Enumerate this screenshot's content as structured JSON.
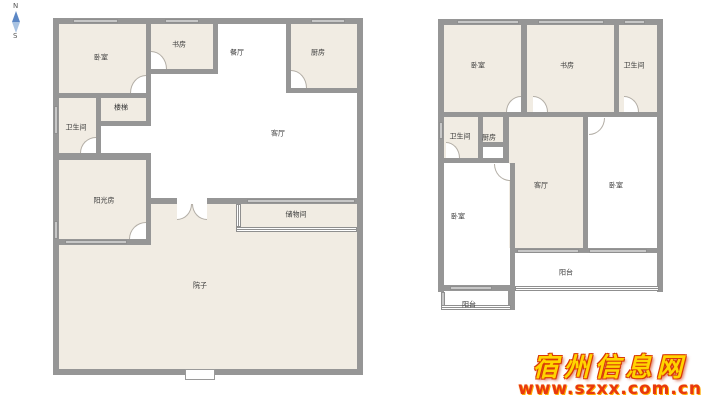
{
  "compass": {
    "north": "N",
    "south": "S"
  },
  "colors": {
    "wall": "#969696",
    "room_fill": "#f1ece3",
    "label_text": "#3a3a3a",
    "compass_needle": "#5b87c5",
    "watermark_gold": "#ffd400",
    "watermark_red": "#e8380d"
  },
  "left_plan": {
    "rooms": {
      "bedroom": "卧室",
      "study": "书房",
      "dining": "餐厅",
      "kitchen": "厨房",
      "living": "客厅",
      "stairs": "楼梯",
      "bathroom": "卫生间",
      "sunroom": "阳光房",
      "storage": "储物间",
      "yard": "院子"
    }
  },
  "right_plan": {
    "rooms": {
      "bedroom1": "卧室",
      "study": "书房",
      "bathroom1": "卫生间",
      "bathroom2": "卫生间",
      "kitchen": "厨房",
      "living": "客厅",
      "bedroom2": "卧室",
      "bedroom3": "卧室",
      "balcony_main": "阳台",
      "balcony_small": "阳台"
    }
  },
  "watermark": {
    "site_name": "宿州信息网",
    "site_url": "www.szxx.com.cn"
  }
}
